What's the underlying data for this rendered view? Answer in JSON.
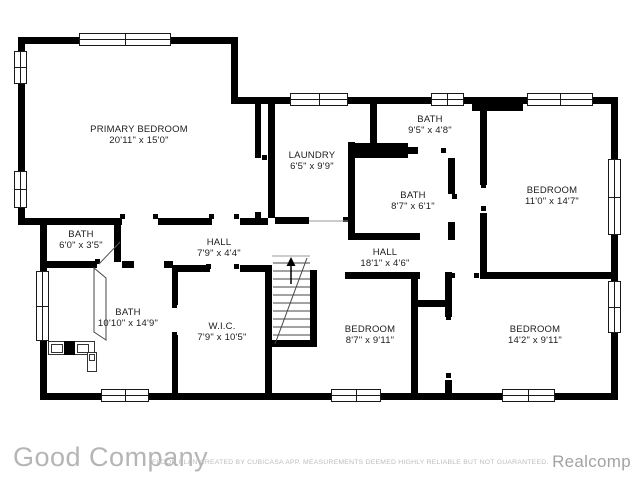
{
  "floorplan": {
    "rooms": [
      {
        "name": "PRIMARY BEDROOM",
        "dims": "20'11\" x 15'0\""
      },
      {
        "name": "LAUNDRY",
        "dims": "6'5\" x 9'9\""
      },
      {
        "name": "BATH",
        "dims": "9'5\" x 4'8\""
      },
      {
        "name": "BEDROOM",
        "dims": "11'0\" x 14'7\""
      },
      {
        "name": "BATH",
        "dims": "8'7\" x 6'1\""
      },
      {
        "name": "BATH",
        "dims": "6'0\" x 3'5\""
      },
      {
        "name": "HALL",
        "dims": "7'9\" x 4'4\""
      },
      {
        "name": "HALL",
        "dims": "18'1\" x 4'6\""
      },
      {
        "name": "BATH",
        "dims": "10'10\" x 14'9\""
      },
      {
        "name": "W.I.C.",
        "dims": "7'9\" x 10'5\""
      },
      {
        "name": "BEDROOM",
        "dims": "8'7\" x 9'11\""
      },
      {
        "name": "BEDROOM",
        "dims": "14'2\" x 9'11\""
      }
    ]
  },
  "footer": {
    "company": "Good Company",
    "disclaimer": "FLOOR PLAN CREATED BY CUBICASA APP. MEASUREMENTS DEEMED HIGHLY RELIABLE BUT NOT GUARANTEED.",
    "brand": "Realcomp"
  },
  "colors": {
    "wall": "#000000",
    "background": "#ffffff",
    "footer_text": "#b5b5b5"
  }
}
